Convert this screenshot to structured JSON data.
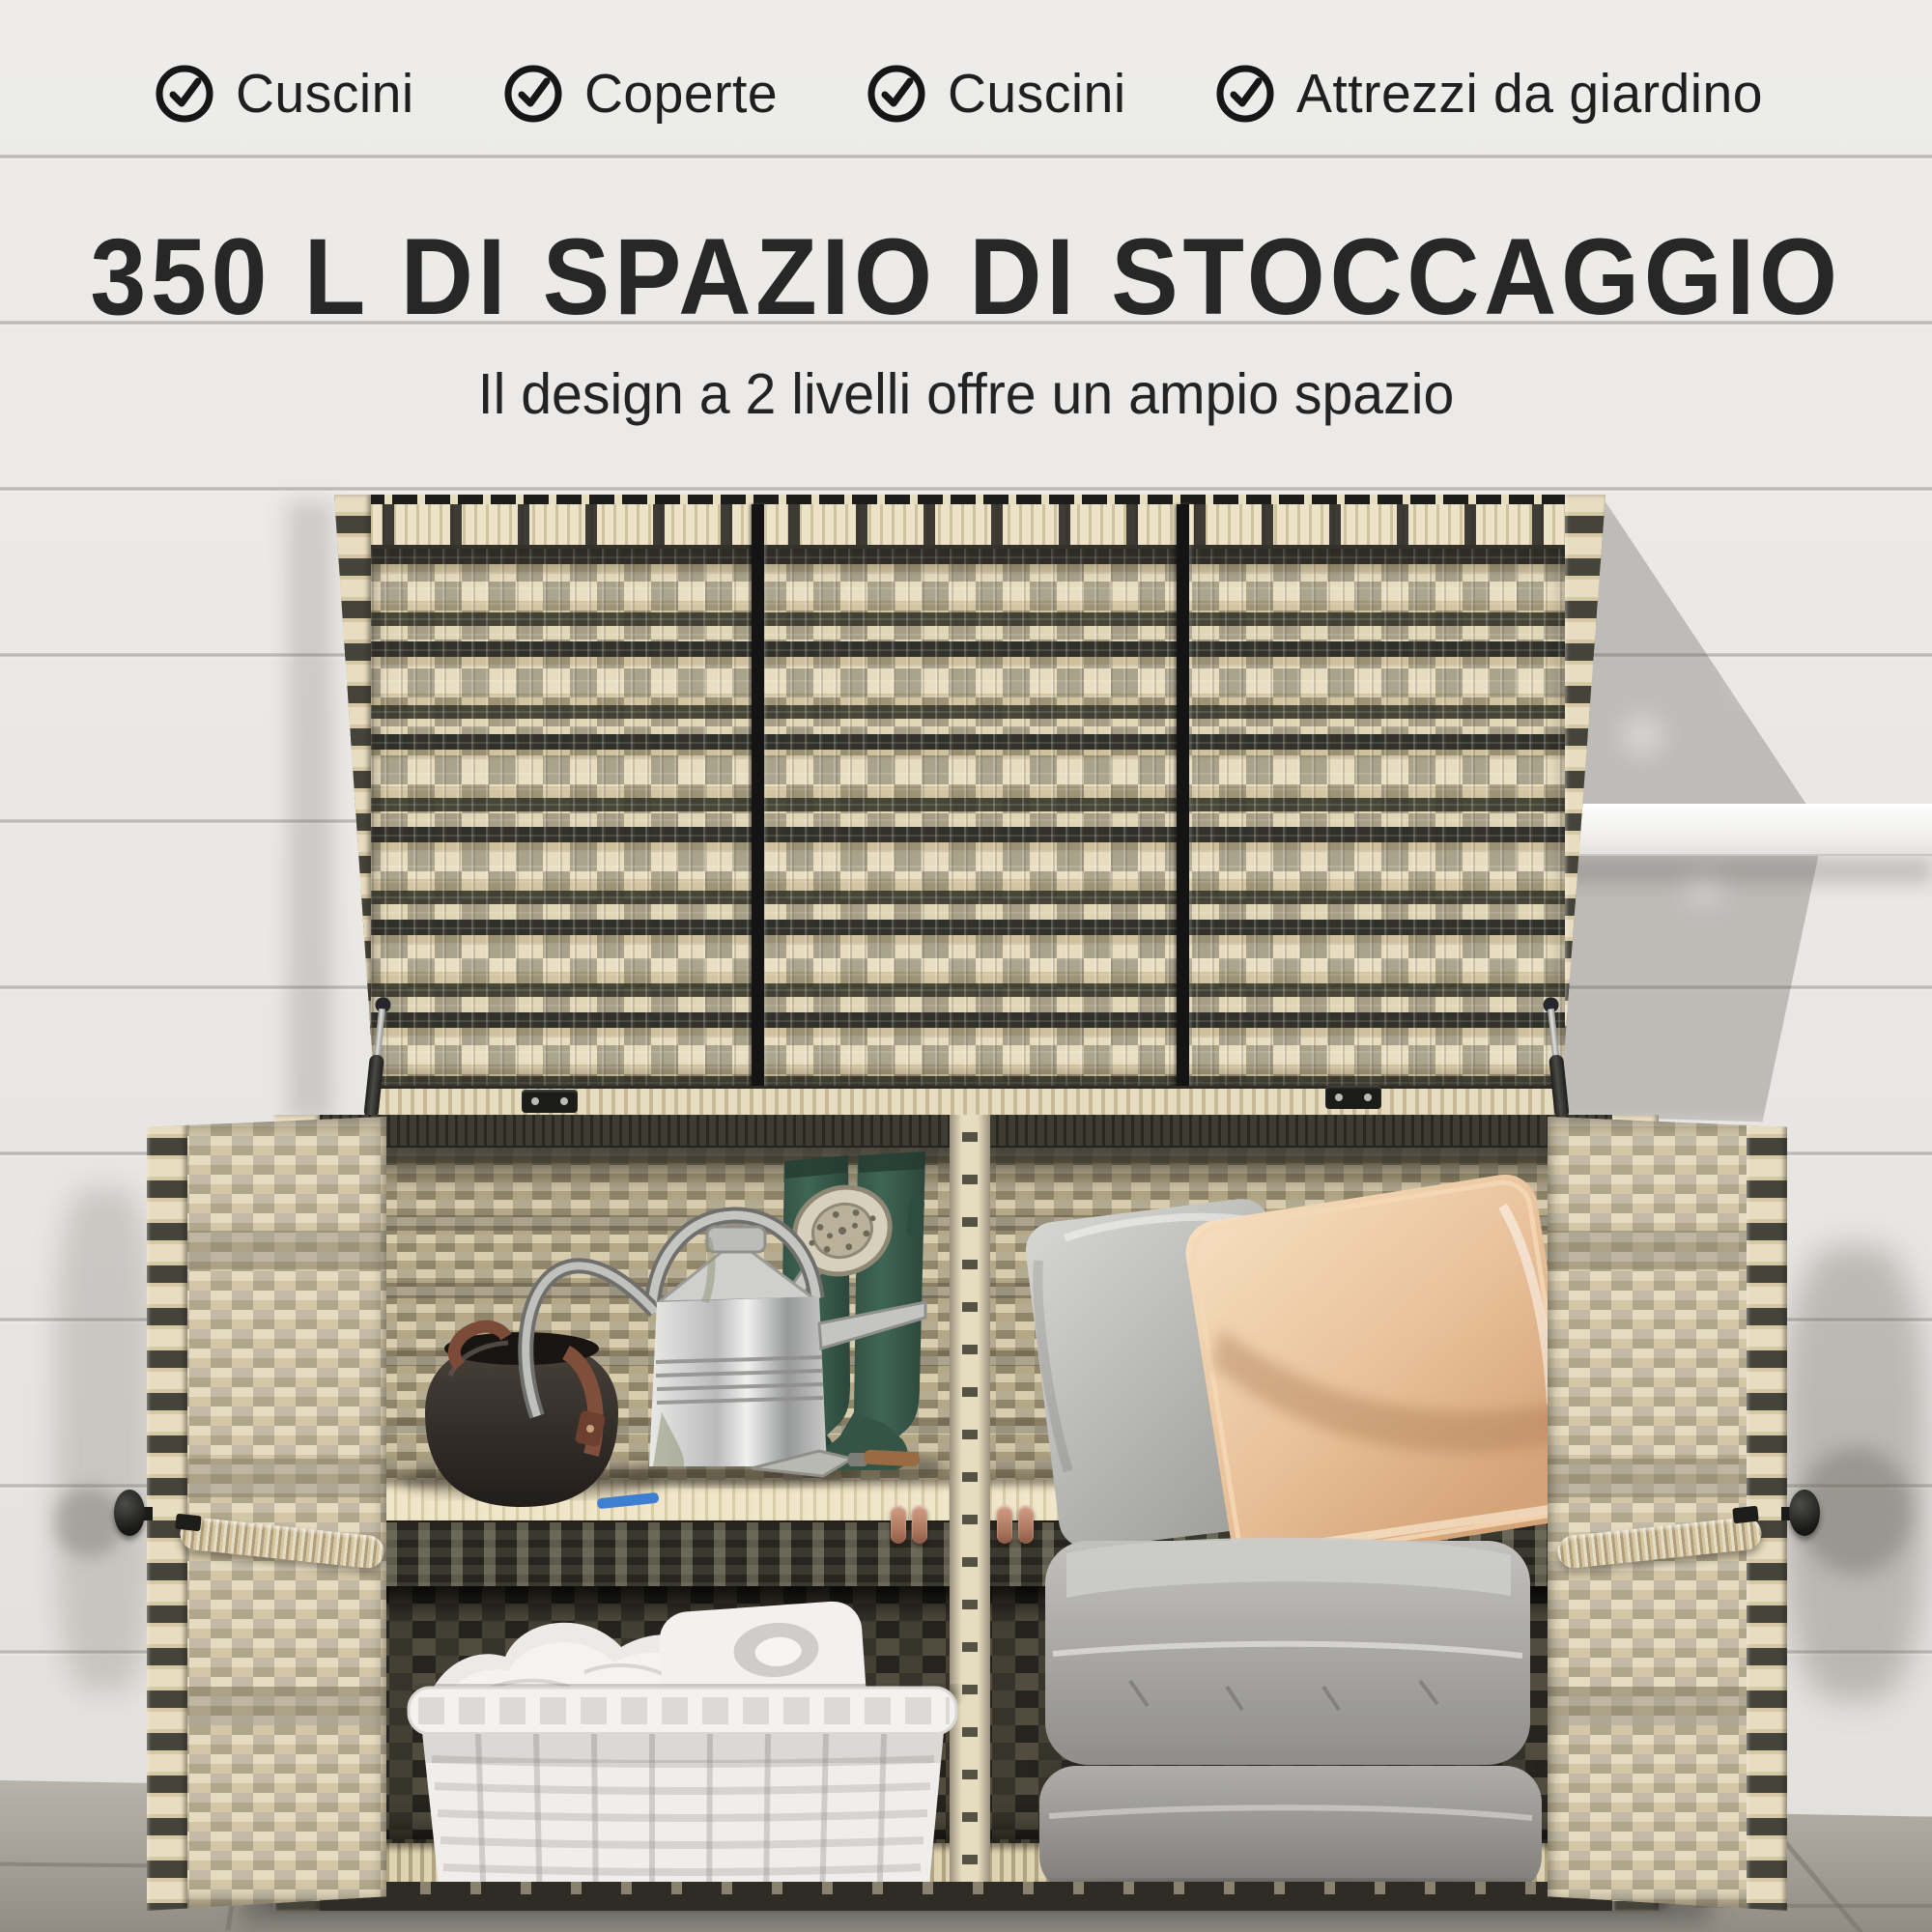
{
  "header": {
    "features": [
      {
        "icon": "check-circle-icon",
        "label": "Cuscini"
      },
      {
        "icon": "check-circle-icon",
        "label": "Coperte"
      },
      {
        "icon": "check-circle-icon",
        "label": "Cuscini"
      },
      {
        "icon": "check-circle-icon",
        "label": "Attrezzi da giardino"
      }
    ],
    "headline": "350 L DI SPAZIO DI STOCCAGGIO",
    "subheadline": "Il design a 2 livelli offre un ampio spazio"
  },
  "colors": {
    "headline_text": "#272727",
    "label_text": "#1f1f1f",
    "icon_black": "#161616",
    "wall": "#e9e7e4",
    "wicker_cream": "#e4d9bb",
    "wicker_dark": "#45453a",
    "lid_frame": "#161616",
    "peach_pillow": "#e9c29b",
    "gray_pillow": "#c6c6c2",
    "cushion_gray": "#a3a29f",
    "boot_green": "#3b5f4d",
    "basket_white": "#f2f1ef",
    "floor_stone": "#a7a39b",
    "copper_handle": "#b07a60",
    "door_handle_tan": "#d6c6a0"
  }
}
